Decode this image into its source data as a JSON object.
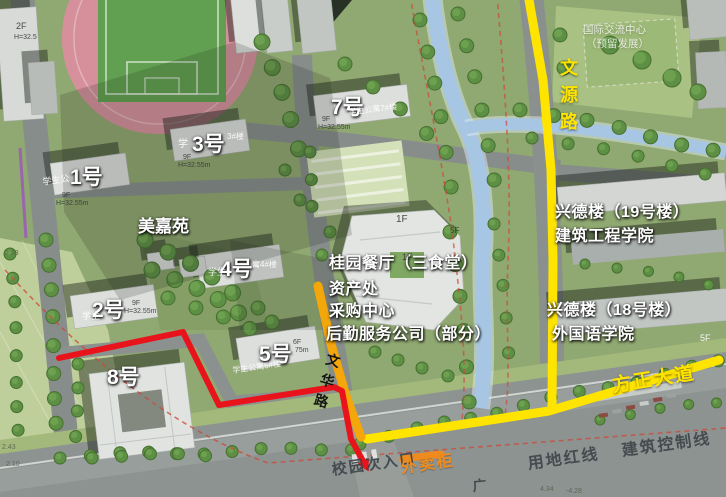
{
  "map": {
    "colors": {
      "route_yellow": "#ffe400",
      "route_orange": "#f3a70a",
      "route_red": "#e8131b",
      "marker_orange": "#ef8b1e",
      "grass": "#90a871",
      "road_gray": "#878d8a",
      "river_blue": "#a6c6e4",
      "track_pink": "#d6909b"
    },
    "labels": [
      {
        "name": "label-building-1",
        "text": "1号",
        "x": 70,
        "y": 167,
        "cls": "bigNum"
      },
      {
        "name": "label-building-3",
        "text": "3号",
        "x": 192,
        "y": 134,
        "cls": "bigNum"
      },
      {
        "name": "label-building-7",
        "text": "7号",
        "x": 331,
        "y": 97,
        "cls": "bigNum"
      },
      {
        "name": "label-building-2",
        "text": "2号",
        "x": 92,
        "y": 300,
        "cls": "bigNum"
      },
      {
        "name": "label-building-4",
        "text": "4号",
        "x": 220,
        "y": 259,
        "cls": "bigNum"
      },
      {
        "name": "label-building-5",
        "text": "5号",
        "x": 259,
        "y": 344,
        "cls": "bigNum"
      },
      {
        "name": "label-building-8",
        "text": "8号",
        "x": 107,
        "y": 367,
        "cls": "bigNum"
      },
      {
        "name": "label-meijiayuan",
        "text": "美嘉苑",
        "x": 138,
        "y": 218,
        "cls": "bigNum",
        "fs": 17
      },
      {
        "name": "label-canteen",
        "text": "桂园餐厅（三食堂）",
        "x": 329,
        "y": 256,
        "cls": "facility"
      },
      {
        "name": "label-assets-office",
        "text": "资产处",
        "x": 329,
        "y": 282,
        "cls": "facility"
      },
      {
        "name": "label-procurement-center",
        "text": "采购中心",
        "x": 329,
        "y": 304,
        "cls": "facility"
      },
      {
        "name": "label-logistics-company",
        "text": "后勤服务公司（部分）",
        "x": 326,
        "y": 327,
        "cls": "facility"
      },
      {
        "name": "label-xingde-19",
        "text": "兴德楼（19号楼）",
        "x": 555,
        "y": 205,
        "cls": "facility"
      },
      {
        "name": "label-civil-engineering",
        "text": "建筑工程学院",
        "x": 555,
        "y": 229,
        "cls": "facility"
      },
      {
        "name": "label-xingde-18",
        "text": "兴德楼（18号楼）",
        "x": 547,
        "y": 303,
        "cls": "facility"
      },
      {
        "name": "label-foreign-languages",
        "text": "外国语学院",
        "x": 552,
        "y": 327,
        "cls": "facility"
      },
      {
        "name": "label-intl-exchange-center",
        "text": "国际交流中心",
        "x": 583,
        "y": 25,
        "cls": "faint"
      },
      {
        "name": "label-reserved-development",
        "text": "（预留发展）",
        "x": 586,
        "y": 39,
        "cls": "faint"
      },
      {
        "name": "label-wenyuan-road",
        "text": "文\n源\n路",
        "x": 560,
        "y": 55,
        "cls": "roadYellowV"
      },
      {
        "name": "label-fangzheng-avenue",
        "text": "方正大道",
        "x": 611,
        "y": 377,
        "cls": "roadYellow",
        "rot": -9
      },
      {
        "name": "label-wenhua-road",
        "text": "文\n华\n路",
        "x": 329,
        "y": 349,
        "cls": "roadBlack",
        "rot": 16
      },
      {
        "name": "label-campus-side-entrance",
        "text": "校园次入口",
        "x": 331,
        "y": 463,
        "cls": "ground",
        "fs": 15,
        "rot": -8
      },
      {
        "name": "label-land-red-line",
        "text": "用地红线",
        "x": 527,
        "y": 457,
        "cls": "ground",
        "rot": -8
      },
      {
        "name": "label-building-control-line",
        "text": "建筑控制线",
        "x": 621,
        "y": 444,
        "cls": "ground",
        "rot": -8
      },
      {
        "name": "label-takeout-cabinet",
        "text": "外卖柜",
        "x": 400,
        "y": 461,
        "cls": "orangeTxt",
        "rot": -8
      },
      {
        "name": "label-plaza-char",
        "text": "广",
        "x": 472,
        "y": 479,
        "cls": "ground",
        "fs": 14,
        "rot": -5
      },
      {
        "text": "2F",
        "x": 16,
        "y": 22,
        "cls": "tinyD",
        "fs": 9
      },
      {
        "text": "H=32.5",
        "x": 14,
        "y": 34,
        "cls": "tinyD"
      },
      {
        "text": "学生公",
        "x": 42,
        "y": 178,
        "cls": "tinyW",
        "fs": 9,
        "rot": -8
      },
      {
        "text": "9F",
        "x": 62,
        "y": 192,
        "cls": "tinyD"
      },
      {
        "text": "H=32.55m",
        "x": 56,
        "y": 200,
        "cls": "tinyD"
      },
      {
        "text": "学",
        "x": 178,
        "y": 140,
        "cls": "tinyW",
        "fs": 10
      },
      {
        "text": "3#楼",
        "x": 227,
        "y": 133,
        "cls": "tinyW",
        "fs": 8
      },
      {
        "text": "9F",
        "x": 183,
        "y": 154,
        "cls": "tinyD"
      },
      {
        "text": "H=32.55m",
        "x": 178,
        "y": 162,
        "cls": "tinyD"
      },
      {
        "text": "学生公寓7#楼",
        "x": 348,
        "y": 109,
        "cls": "tinyW",
        "fs": 8,
        "rot": -7
      },
      {
        "text": "9F",
        "x": 322,
        "y": 116,
        "cls": "tinyD"
      },
      {
        "text": "H=32.55m",
        "x": 318,
        "y": 124,
        "cls": "tinyD"
      },
      {
        "text": "学生",
        "x": 82,
        "y": 312,
        "cls": "tinyW",
        "fs": 9
      },
      {
        "text": "9F",
        "x": 132,
        "y": 300,
        "cls": "tinyD"
      },
      {
        "text": "H=32.55m",
        "x": 124,
        "y": 308,
        "cls": "tinyD"
      },
      {
        "text": "学生",
        "x": 208,
        "y": 268,
        "cls": "tinyW",
        "fs": 9
      },
      {
        "text": "寓4#楼",
        "x": 252,
        "y": 261,
        "cls": "tinyW",
        "fs": 8
      },
      {
        "text": "6F",
        "x": 293,
        "y": 339,
        "cls": "tinyD"
      },
      {
        "text": "75m",
        "x": 295,
        "y": 347,
        "cls": "tinyD"
      },
      {
        "text": "学生公寓5#楼",
        "x": 232,
        "y": 367,
        "cls": "tinyW",
        "fs": 8,
        "rot": -8
      },
      {
        "text": "1F",
        "x": 396,
        "y": 215,
        "cls": "tinyD",
        "fs": 10
      },
      {
        "text": "1F",
        "x": 402,
        "y": 253,
        "cls": "tinyD",
        "fs": 9
      },
      {
        "text": "5F",
        "x": 450,
        "y": 227,
        "cls": "tinyD",
        "fs": 8
      },
      {
        "text": "5F",
        "x": 700,
        "y": 334,
        "cls": "tinyW",
        "fs": 9
      },
      {
        "text": "2.33",
        "x": 5,
        "y": 250,
        "cls": "tinyG"
      },
      {
        "text": "2.43",
        "x": 2,
        "y": 444,
        "cls": "tinyG"
      },
      {
        "text": "2.10",
        "x": 6,
        "y": 461,
        "cls": "tinyG"
      },
      {
        "text": "4.34",
        "x": 540,
        "y": 486,
        "cls": "tinyG"
      },
      {
        "text": "-4.28",
        "x": 566,
        "y": 488,
        "cls": "tinyG"
      }
    ],
    "routes": {
      "wenyuan-road-line": {
        "color": "#ffe400",
        "width": 9,
        "points": [
          [
            529,
            0
          ],
          [
            543,
            80
          ],
          [
            551,
            170
          ],
          [
            553,
            260
          ],
          [
            552,
            410
          ]
        ]
      },
      "fangzheng-avenue-line": {
        "color": "#ffe400",
        "width": 9,
        "points": [
          [
            367,
            439
          ],
          [
            549,
            411
          ],
          [
            719,
            360
          ]
        ]
      },
      "wenhua-road-line": {
        "color": "#f3a70a",
        "width": 9,
        "points": [
          [
            318,
            286
          ],
          [
            331,
            344
          ],
          [
            346,
            396
          ],
          [
            361,
            437
          ]
        ]
      },
      "red-walking-route": {
        "color": "#e8131b",
        "width": 6,
        "arrow": true,
        "points": [
          [
            59,
            358
          ],
          [
            183,
            332
          ],
          [
            219,
            405
          ],
          [
            334,
            387
          ],
          [
            342,
            391
          ],
          [
            351,
            439
          ],
          [
            363,
            461
          ]
        ]
      },
      "takeout-cabinet-marker": {
        "color": "#ef8b1e",
        "width": 7,
        "points": [
          [
            402,
            459
          ],
          [
            441,
            454
          ]
        ]
      }
    }
  }
}
